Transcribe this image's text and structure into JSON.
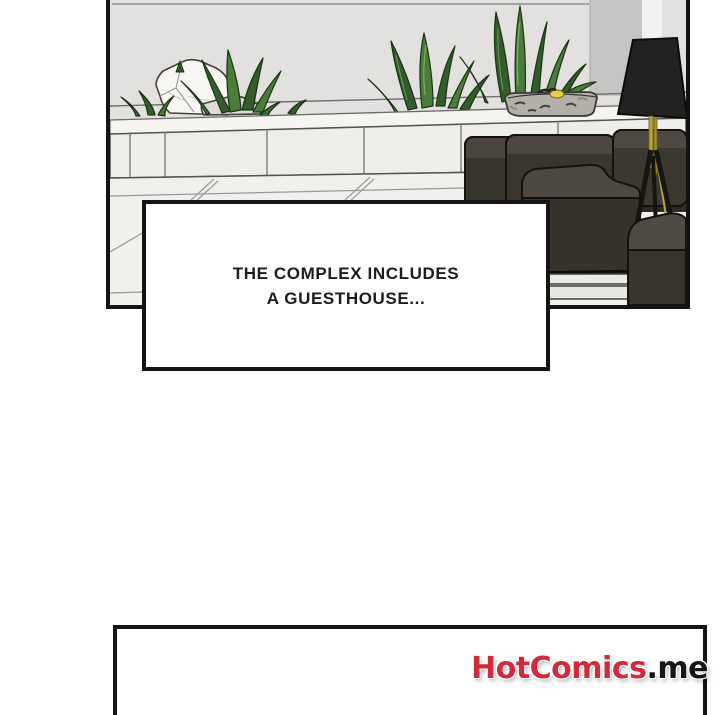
{
  "caption": {
    "line1": "THE COMPLEX INCLUDES",
    "line2": "A GUESTHOUSE..."
  },
  "watermark": {
    "brand": "HotComics",
    "domain": ".me"
  },
  "colors": {
    "brand_red": "#cf2b3a",
    "ink": "#161616",
    "panel_border": "#141414",
    "wall": "#e2e1df",
    "caption_text": "#1c1c1c"
  }
}
